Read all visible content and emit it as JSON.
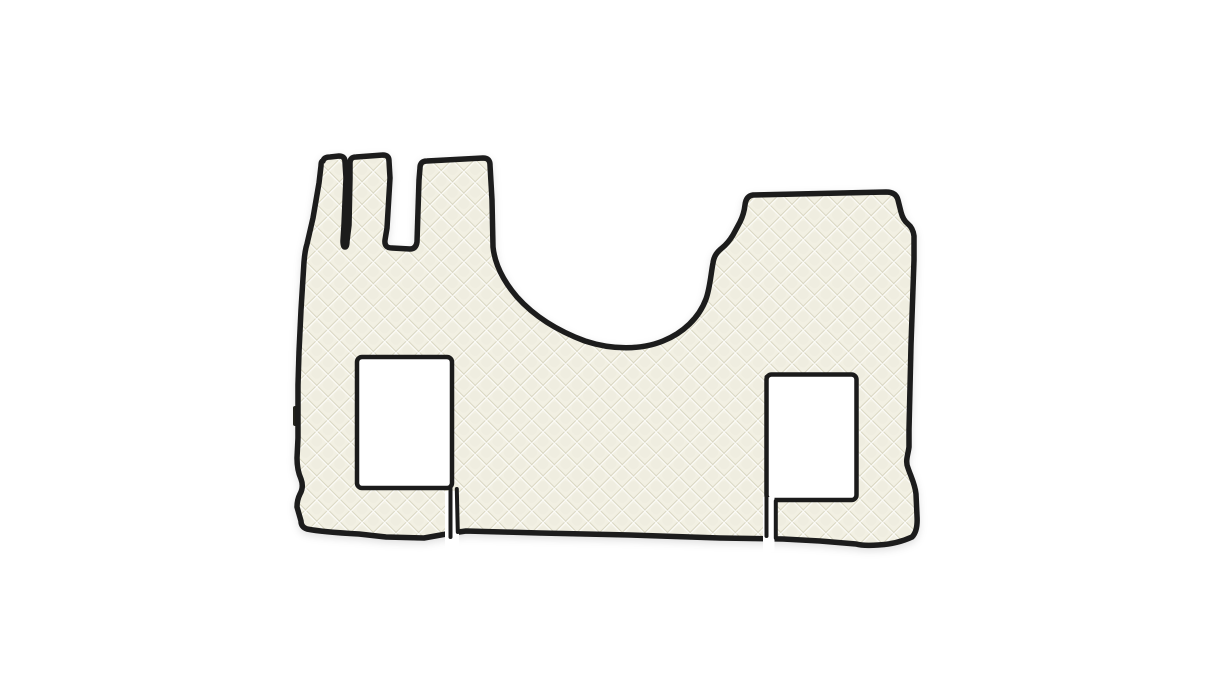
{
  "scene": {
    "kind": "product-photo",
    "subject": "quilted-leather-truck-cab-floor-mat-set",
    "background_style": "plain seamless white",
    "visible_text": "",
    "elements": [
      "mat-silhouette",
      "driver-seat-cutout",
      "passenger-seat-cutout",
      "piece-gap-left",
      "piece-gap-right",
      "brand-tag"
    ]
  },
  "colors": {
    "background": "#ffffff",
    "mat_base": "#f2f0e3",
    "mat_base_alt": "#eceadb",
    "seam_shadow": "#d7d4bf",
    "seam_highlight": "#ffffff",
    "piping": "#1b1b1b",
    "tag": "#26261f",
    "tag_stripe": "#8a8878"
  },
  "mat": {
    "quilting": "diagonal diamond quilt, approx 23px diamond pitch",
    "edge_trim": "dark piping around every piece and cutout",
    "cutouts": {
      "driver_seat": "rectangular opening, left piece",
      "passenger_seat": "rectangular opening, right piece"
    },
    "pieces": "main contoured mat with two small seat-base strips separated by thin gaps",
    "top_features": "two narrow prongs and one wide block on upper left, engine-tunnel dip in middle, stepped block on upper right"
  }
}
